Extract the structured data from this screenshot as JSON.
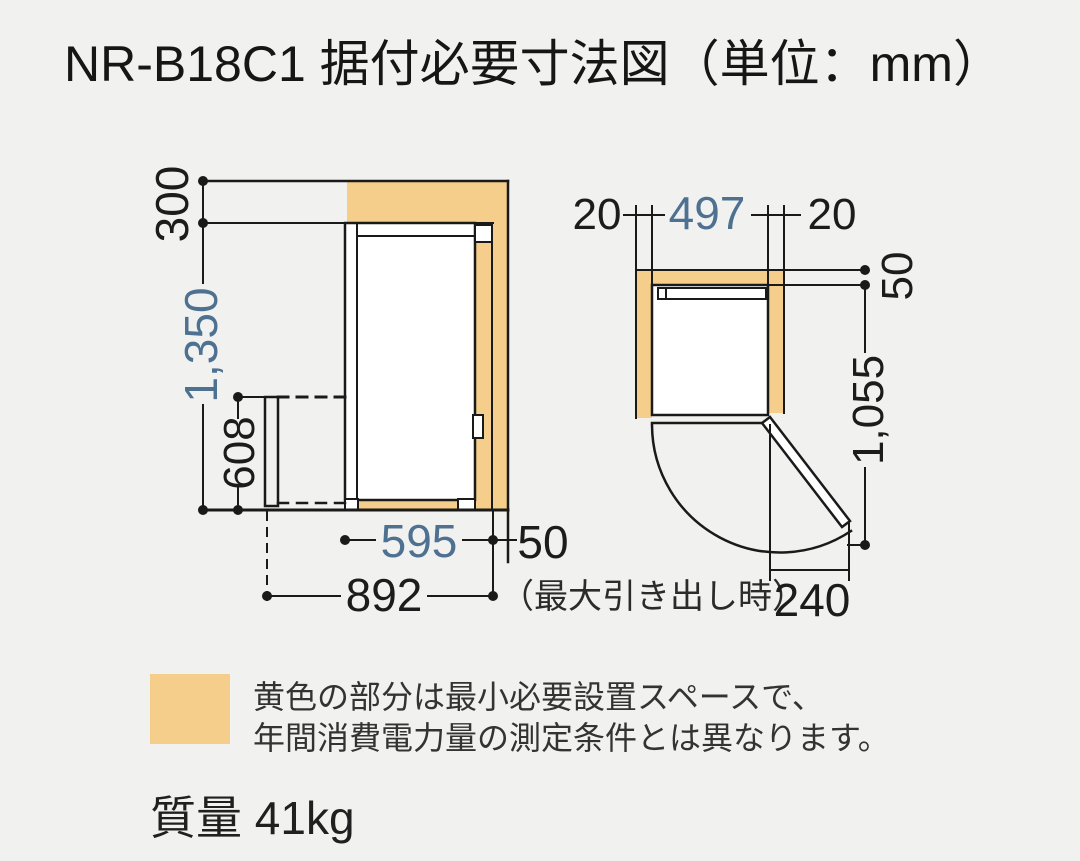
{
  "title": "NR-B18C1 据付必要寸法図（単位：mm）",
  "colors": {
    "background": "#F1F1EF",
    "min_space_highlight": "#F6CE8B",
    "dimension_blue": "#4E7192",
    "line_black": "#1A1A1A"
  },
  "side_view": {
    "top_clearance": "300",
    "min_space_height": "1,350",
    "drawer_front_height": "608",
    "body_depth": "595",
    "rear_clearance": "50",
    "pullout_depth": "892",
    "pullout_note": "（最大引き出し時）"
  },
  "top_view": {
    "left_clearance": "20",
    "min_space_width": "497",
    "right_clearance": "20",
    "rear_clearance": "50",
    "min_space_depth": "1,055",
    "door_open_clearance": "240"
  },
  "legend": {
    "note_line1": "黄色の部分は最小必要設置スペースで、",
    "note_line2": "年間消費電力量の測定条件とは異なります。"
  },
  "weight": "質量 41kg"
}
